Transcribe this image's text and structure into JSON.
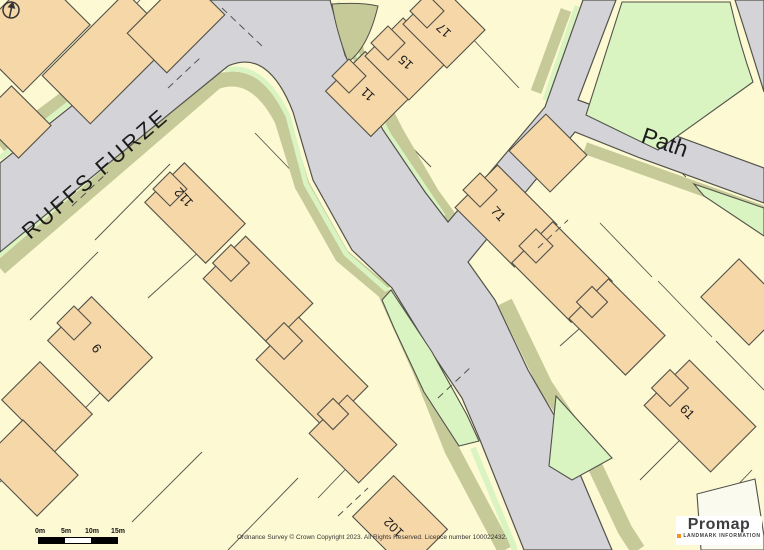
{
  "map": {
    "street_label": "RUFFS FURZE",
    "path_label": "Path",
    "house_numbers": {
      "h17": "17",
      "h15": "15",
      "h11": "11",
      "h112": "112",
      "h71": "71",
      "h9": "9",
      "h61": "61",
      "h102": "102"
    }
  },
  "scale_bar": {
    "labels": [
      "0m",
      "5m",
      "10m",
      "15m"
    ]
  },
  "footer": {
    "copyright": "Ordnance Survey © Crown Copyright 2023. All Rights Reserved. Licence number 100022432."
  },
  "logo": {
    "title": "Promap",
    "subtitle": "LANDMARK INFORMATION"
  },
  "colors": {
    "parcel": "#FCF9D3",
    "building": "#F6D7A8",
    "road": "#D4D3D7",
    "verge": "#C6C998",
    "green": "#D9F3C1",
    "outline": "#52524A",
    "label": "#1C1C1C",
    "accent_orange": "#F6921E",
    "logo_text": "#3E3E40"
  }
}
